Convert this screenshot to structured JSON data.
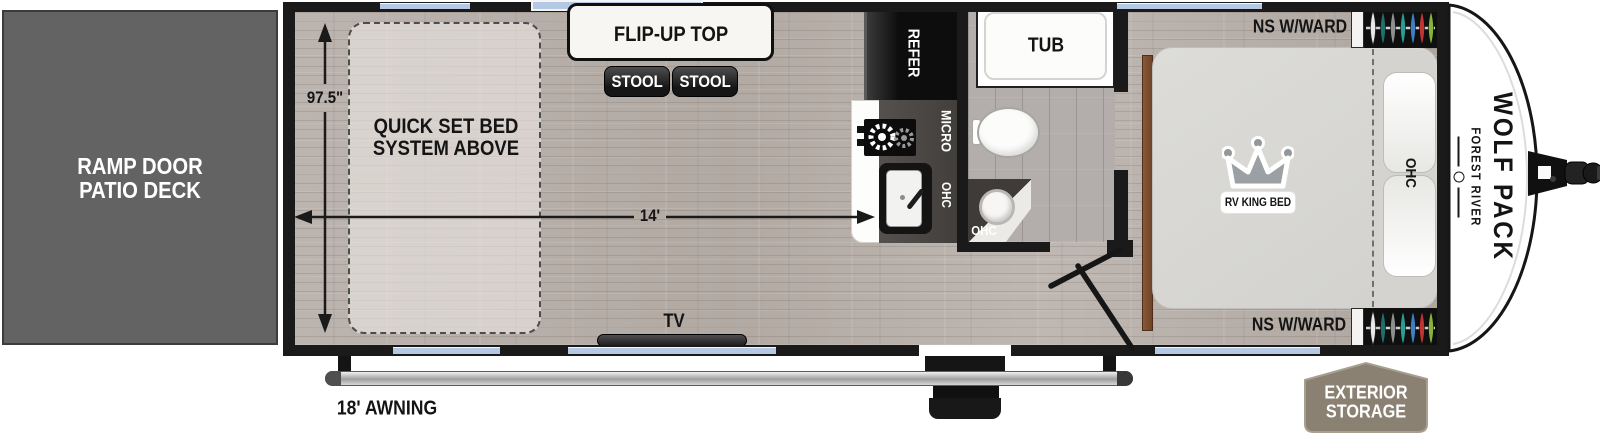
{
  "ramp": {
    "line1": "RAMP DOOR",
    "line2": "PATIO DECK"
  },
  "dims": {
    "width": "97.5\"",
    "length": "14'",
    "awning": "18' AWNING"
  },
  "living": {
    "bed_line1": "QUICK SET BED",
    "bed_line2": "SYSTEM ABOVE",
    "flip_top": "FLIP-UP TOP",
    "stools": [
      "STOOL",
      "STOOL"
    ],
    "tv": "TV"
  },
  "kitchen": {
    "refer": "REFER",
    "micro": "MICRO",
    "ohc": "OHC"
  },
  "bath": {
    "tub": "TUB",
    "ohc": "OHC"
  },
  "bedroom": {
    "bed": "RV KING BED",
    "ohc": "OHC",
    "ns_top": "NS W/WARD",
    "ns_bottom": "NS W/WARD"
  },
  "exterior": {
    "storage_line1": "EXTERIOR",
    "storage_line2": "STORAGE",
    "brand": "FOREST RIVER",
    "model": "WOLF PACK"
  },
  "colors": {
    "window": "#b6c9e4",
    "ramp": "#636363",
    "wall": "#1a1a1a",
    "floor": "#b5aca6",
    "storage_badge": "#8a8172",
    "hangers": [
      "#e9e9e9",
      "#1f6f6a",
      "#8f8f8f",
      "#2a9d93",
      "#3f7fc1",
      "#c23434",
      "#86b33c"
    ]
  }
}
